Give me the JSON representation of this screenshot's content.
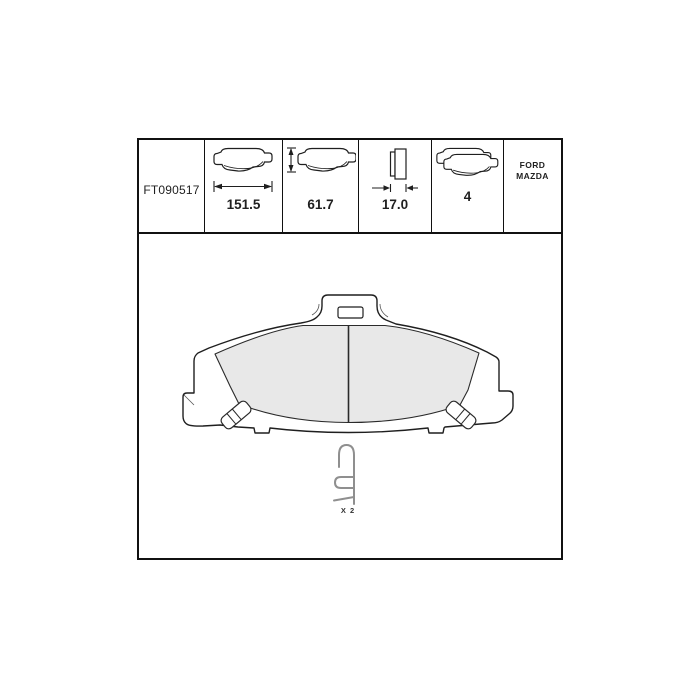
{
  "spec_table": {
    "part_number": "FT090517",
    "columns": [
      {
        "icon": "pad-width-icon",
        "value": "151.5"
      },
      {
        "icon": "pad-height-icon",
        "value": "61.7"
      },
      {
        "icon": "pad-thickness-icon",
        "value": "17.0"
      },
      {
        "icon": "pad-set-icon",
        "value": "4"
      }
    ],
    "makes": [
      "FORD",
      "MAZDA"
    ]
  },
  "drawing": {
    "clip_quantity_label": "X 2",
    "parts": [
      "brake-pad-front-view",
      "retaining-clip"
    ]
  },
  "colors": {
    "line": "#1f1f1f",
    "friction_fill": "#e8e8e8",
    "clip_stroke": "#8f8f8f",
    "background": "#ffffff"
  }
}
